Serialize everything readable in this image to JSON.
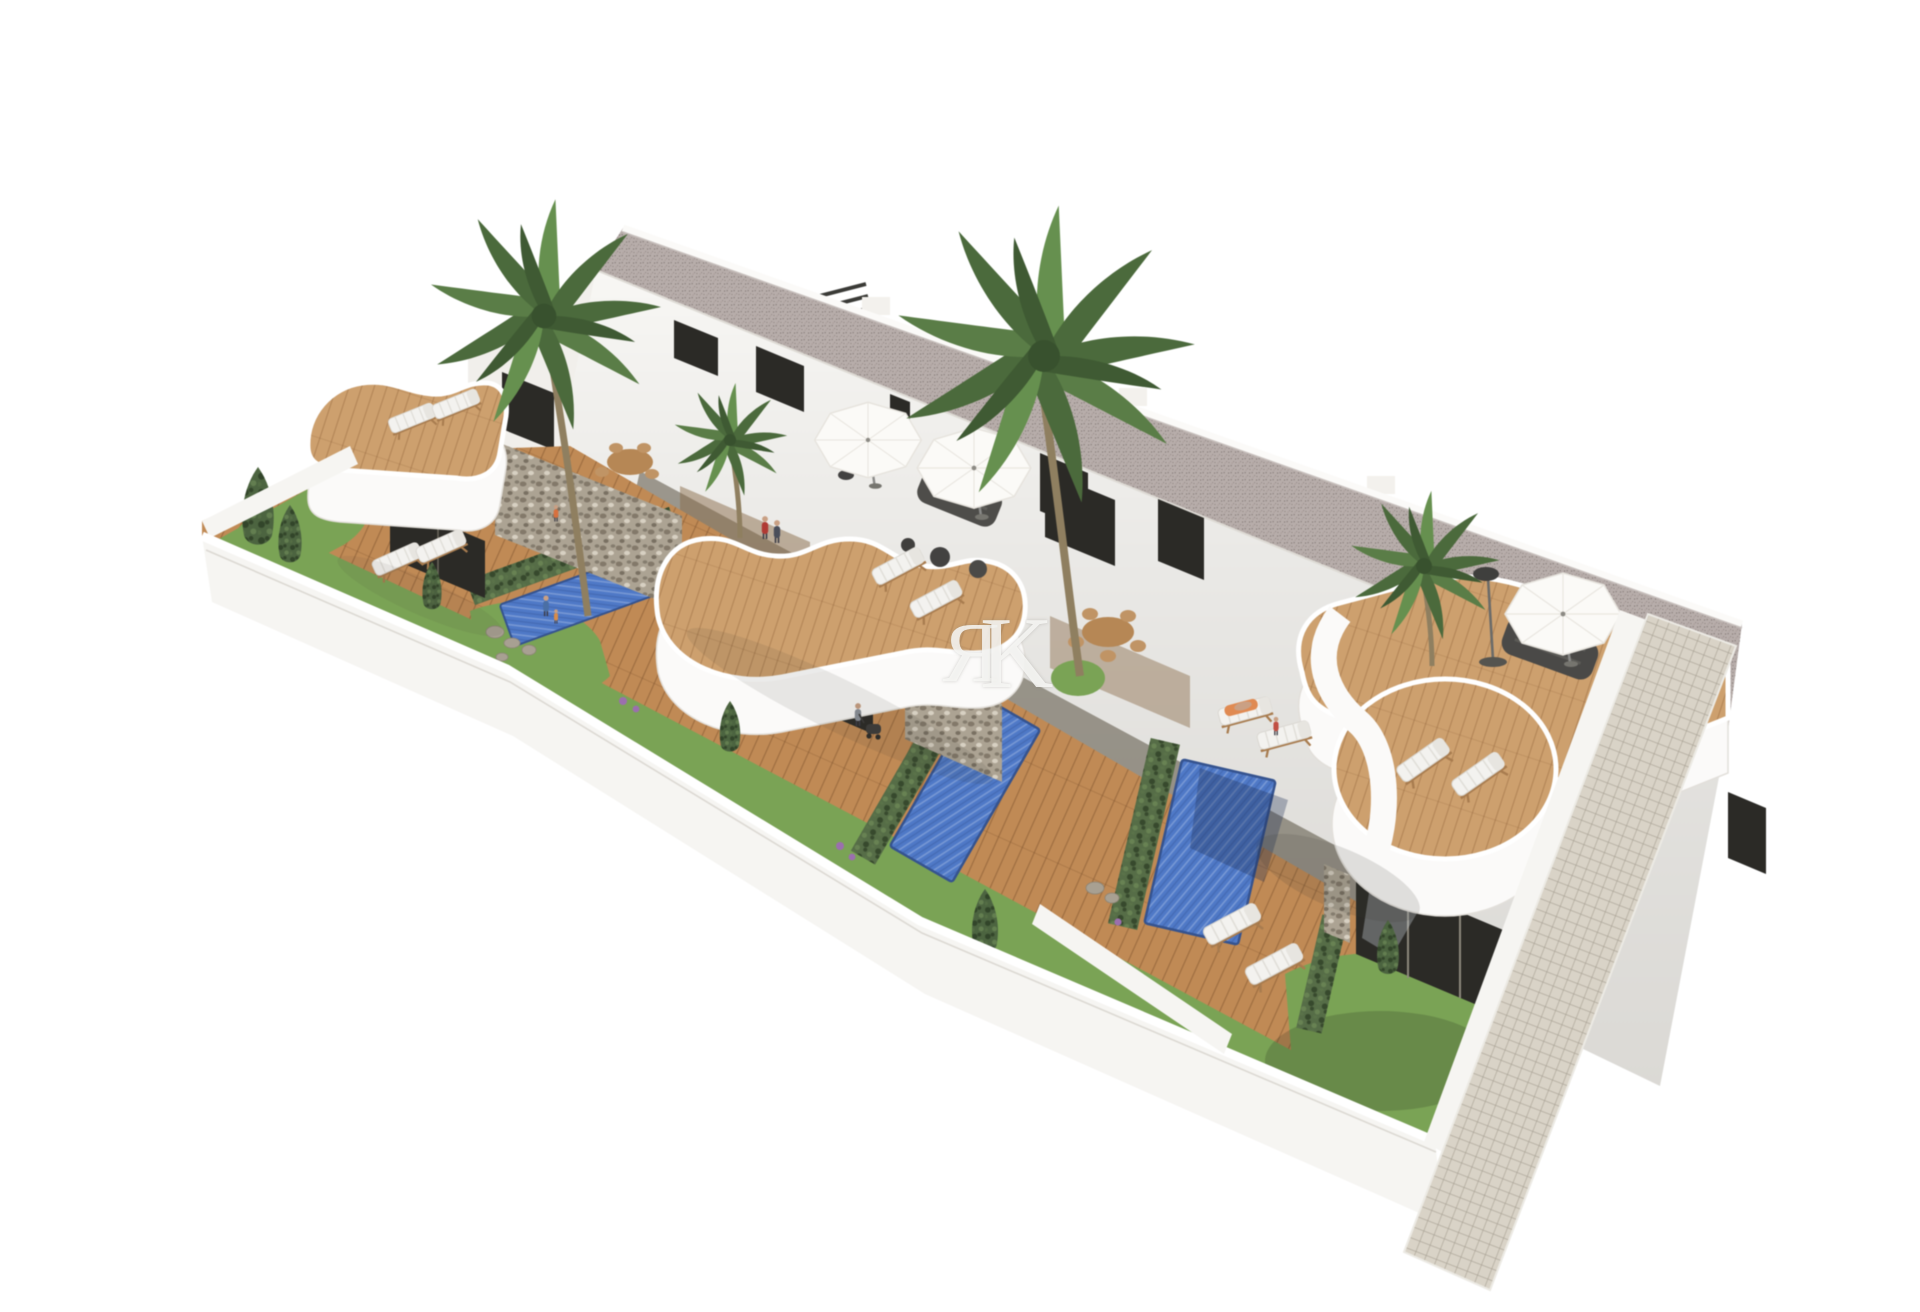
{
  "image": {
    "kind": "architectural-3d-render",
    "description": "Aerial 3D architectural rendering of a row of modern white townhouses with private gardens, wooden sun decks, three rectangular swimming pools, curved wavy roof terraces, palm trees, hedges and a cobbled side walkway, isolated on a white background.",
    "watermark": {
      "letter_1": "Я",
      "letter_2": "K"
    }
  },
  "scene": {
    "units_visible": 3,
    "pools": 3,
    "palm_trees": 4,
    "parasols": 3,
    "sun_loungers": 12,
    "dining_sets": 2,
    "people": 8
  },
  "colors": {
    "background": "#ffffff",
    "building_white": "#f8f7f4",
    "building_shade": "#ecebe6",
    "roof_speckle": "#b7adaa",
    "pool_blue": "#4f79c7",
    "deck_wood": "#c08a55",
    "terrace_wood": "#cda06e",
    "grass_green": "#7aa355",
    "hedge_green": "#566d47",
    "stone_gray": "#aca393",
    "glass_dark": "#2b2a26",
    "walkway_tile": "#d9d3c7",
    "wall_white": "#f6f5f2",
    "furniture_dark": "#4b4a47",
    "lounger_white": "#f3f2ef",
    "trunk_brown": "#8f7f60"
  }
}
